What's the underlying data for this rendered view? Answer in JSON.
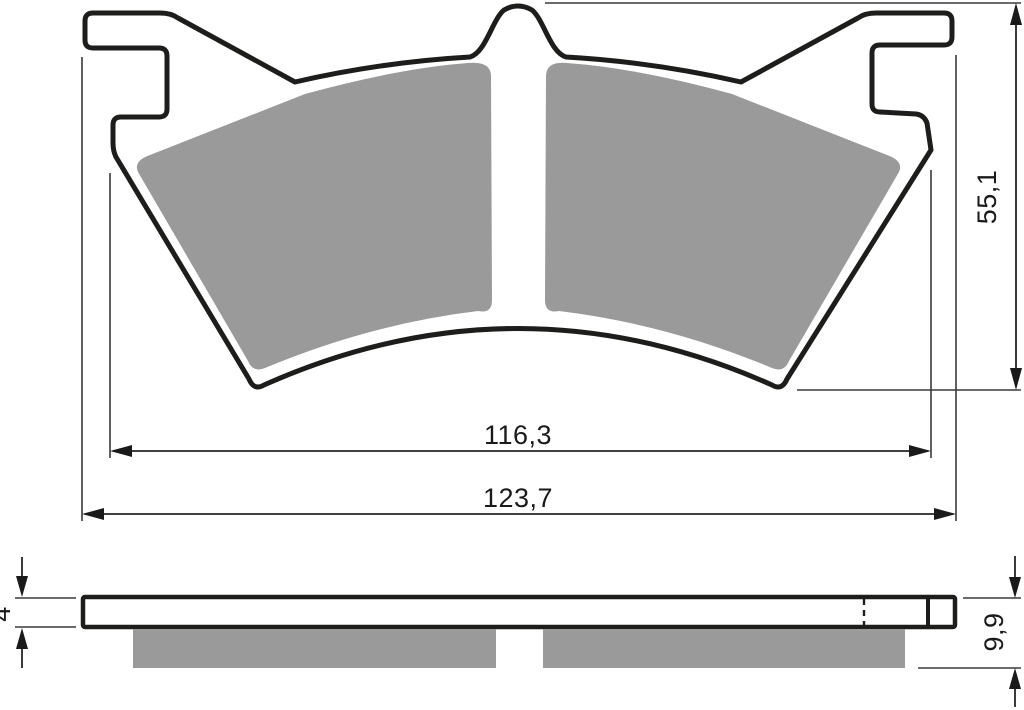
{
  "drawing": {
    "subject": "brake-pad-technical-drawing",
    "dimensions": {
      "inner_width": "116,3",
      "overall_width": "123,7",
      "pad_height": "55,1",
      "backplate_thickness": "4",
      "overall_thickness": "9,9"
    },
    "colors": {
      "friction_material": "#9a9a9a",
      "outline": "#1d1d1b",
      "dimension_lines": "#3a3a3a",
      "background": "#ffffff"
    }
  }
}
